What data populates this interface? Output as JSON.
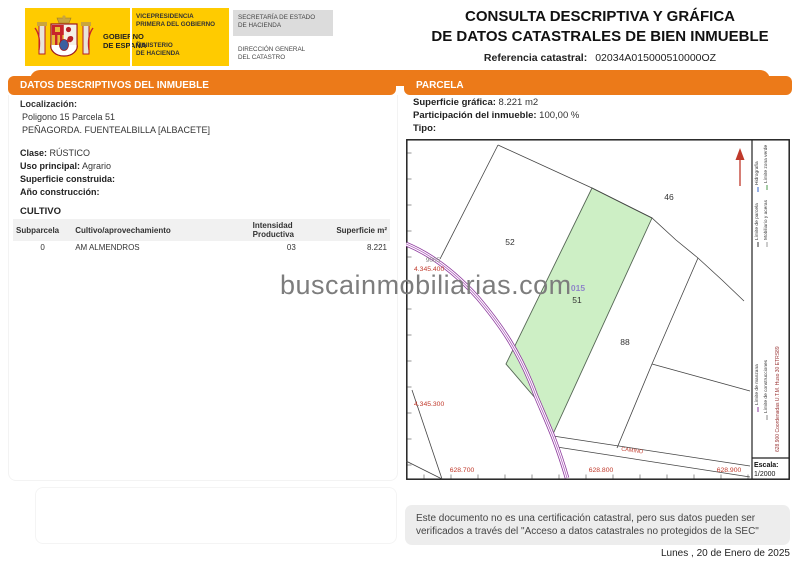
{
  "header": {
    "gobierno": "GOBIERNO\nDE ESPAÑA",
    "vicepresidencia": "VICEPRESIDENCIA\nPRIMERA DEL GOBIERNO",
    "ministerio": "MINISTERIO\nDE HACIENDA",
    "secretaria": "SECRETARÍA DE ESTADO\nDE HACIENDA",
    "direccion_general": "DIRECCIÓN GENERAL\nDEL CATASTRO",
    "title_line1": "CONSULTA DESCRIPTIVA Y GRÁFICA",
    "title_line2": "DE DATOS CATASTRALES DE BIEN INMUEBLE",
    "ref_label": "Referencia catastral:",
    "ref_value": "02034A015000510000OZ"
  },
  "left_panel": {
    "section_title": "DATOS DESCRIPTIVOS DEL INMUEBLE",
    "localizacion_label": "Localización:",
    "localizacion_line1": "Poligono 15 Parcela 51",
    "localizacion_line2": "PEÑAGORDA. FUENTEALBILLA [ALBACETE]",
    "clase_label": "Clase:",
    "clase_value": "RÚSTICO",
    "uso_label": "Uso principal:",
    "uso_value": "Agrario",
    "superficie_label": "Superficie construida:",
    "superficie_value": "",
    "ano_label": "Año construcción:",
    "ano_value": "",
    "cultivo_title": "CULTIVO",
    "table": {
      "headers": [
        "Subparcela",
        "Cultivo/aprovechamiento",
        "Intensidad Productiva",
        "Superficie m²"
      ],
      "rows": [
        [
          "0",
          "AM ALMENDROS",
          "03",
          "8.221"
        ]
      ]
    }
  },
  "right_panel": {
    "section_title": "PARCELA",
    "superficie_label": "Superficie gráfica:",
    "superficie_value": "8.221 m2",
    "participacion_label": "Participación del inmueble:",
    "participacion_value": "100,00 %",
    "tipo_label": "Tipo:",
    "tipo_value": ""
  },
  "map": {
    "parcel_52": "52",
    "parcel_46": "46",
    "parcel_88": "88",
    "parcel_road": "9005",
    "highlight_subparcel": "015",
    "highlight_parcel": "51",
    "camino_label": "CAMINO",
    "coord_x1": "628.700",
    "coord_x2": "628.800",
    "coord_x3": "628.900",
    "coord_y1": "4.345.400",
    "coord_y2": "4.345.300",
    "legend_parcela": "Límite de parcela",
    "legend_hidrografia": "Hidrografía",
    "legend_mobiliario": "Mobiliario y aceras",
    "legend_zonaverde": "Límite zona verde",
    "legend_manzana": "Límite de manzana",
    "legend_construcciones": "Límite de construcciones",
    "utm_note": "628.900 Coordenadas U.T.M. Huso 30 ETRS89",
    "escala_label": "Escala:",
    "escala_value": "1/2000",
    "highlight_color": "#CDEFC5",
    "road_color": "#8E3A9E",
    "coord_color": "#C0392B"
  },
  "watermark": "buscainmobiliarias.com",
  "footer": {
    "disclaimer": "Este documento no es una certificación catastral, pero sus datos pueden ser verificados a través del \"Acceso a datos catastrales no protegidos de la SEC\"",
    "date": "Lunes , 20 de Enero de 2025"
  },
  "colors": {
    "accent_orange": "#EC7A19",
    "brand_yellow": "#FFCB00",
    "header_gray": "#DCDCDC"
  }
}
